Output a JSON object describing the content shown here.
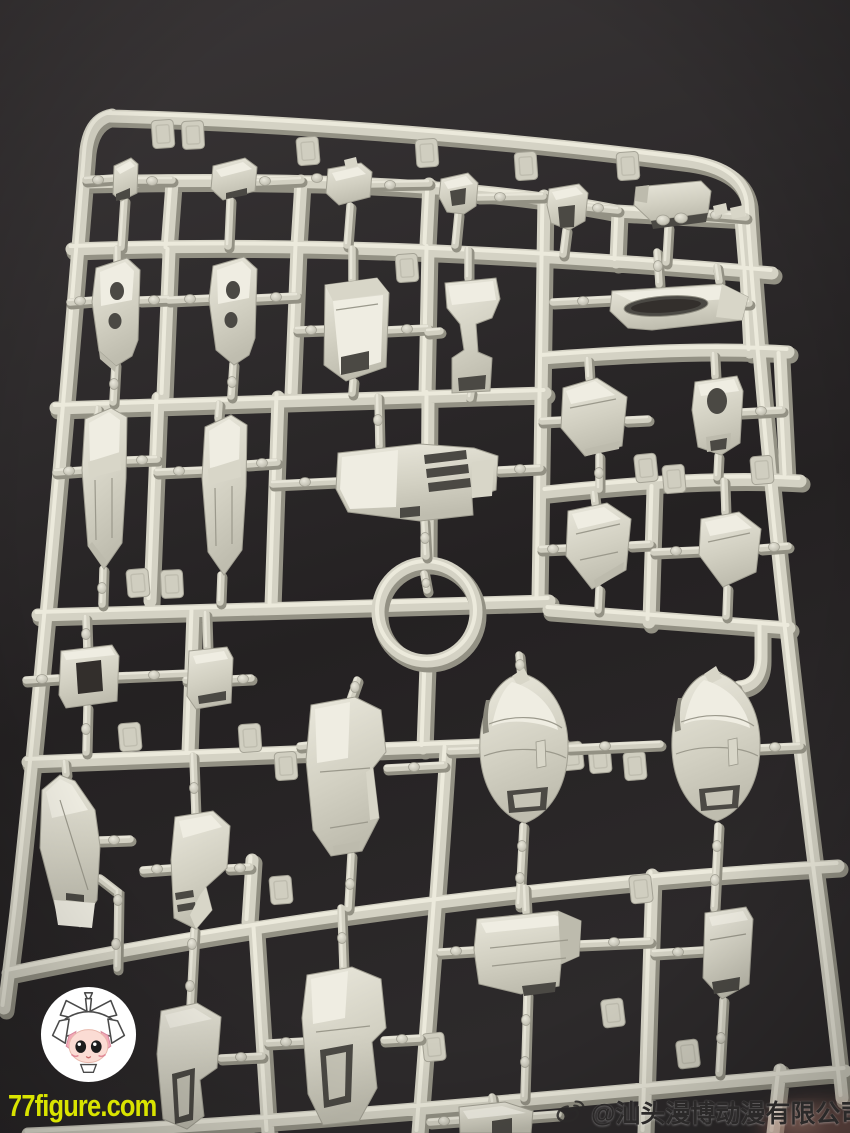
{
  "scene": {
    "subject": "Light gray plastic model-kit sprue (runner) full of unassembled mecha armor parts, photographed on a dark gray surface",
    "background_color": "#2c292a",
    "plastic_color": "#d4d2c4",
    "plastic_highlight": "#eeecdf",
    "plastic_shadow": "#939184"
  },
  "watermarks": {
    "site": {
      "text": "77figure.com",
      "color": "#d9e400"
    },
    "weibo": {
      "handle": "@汕头漫博动漫有限公司",
      "color": "#2b2929",
      "icon": "weibo-logo-icon"
    },
    "mascot": {
      "style": "white circular badge with chibi mecha-girl mascot",
      "background": "#ffffff"
    }
  }
}
